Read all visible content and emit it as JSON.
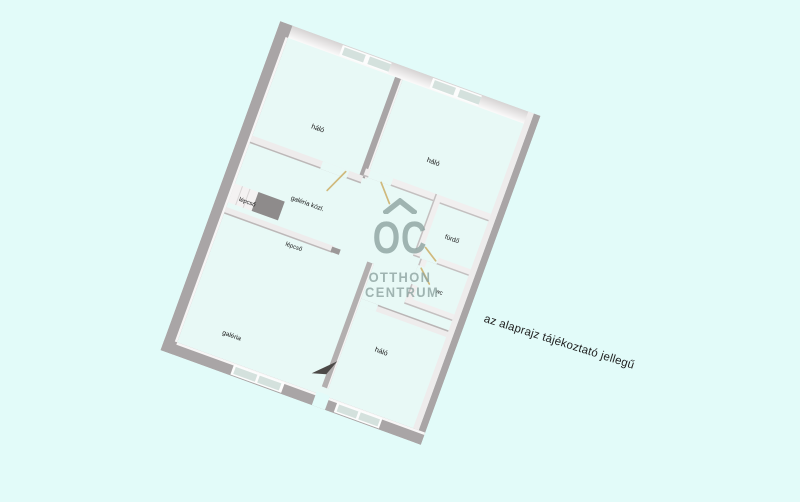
{
  "rooms": {
    "bedroom_top_left": {
      "label": "háló"
    },
    "bedroom_top_right": {
      "label": "háló"
    },
    "gallery_corridor": {
      "label": "galéria közl."
    },
    "stairs_upper": {
      "label": "lépcső"
    },
    "stairs_lower": {
      "label": "lépcső"
    },
    "bathroom": {
      "label": "fürdő"
    },
    "wc": {
      "label": "wc"
    },
    "gallery": {
      "label": "galéria"
    },
    "bedroom_bottom": {
      "label": "háló"
    }
  },
  "watermark": {
    "logo_text": "OC",
    "logo_roof_icon": "house-roof",
    "line1": "OTTHON",
    "line2": "CENTRUM"
  },
  "disclaimer": "az alaprajz tájékoztató jellegű",
  "colors": {
    "background": "#e2fbf9",
    "floor": "#e8f9f6",
    "wall_dark": "#a9a5a6",
    "wall_light": "#f1efef",
    "window_pane": "#d4e1dd",
    "stair_landing": "#8e8b8b",
    "door_leaf": "#d0b97c",
    "entrance_arrow": "#4c4947",
    "watermark": "#8da3a0",
    "text": "#161616"
  }
}
